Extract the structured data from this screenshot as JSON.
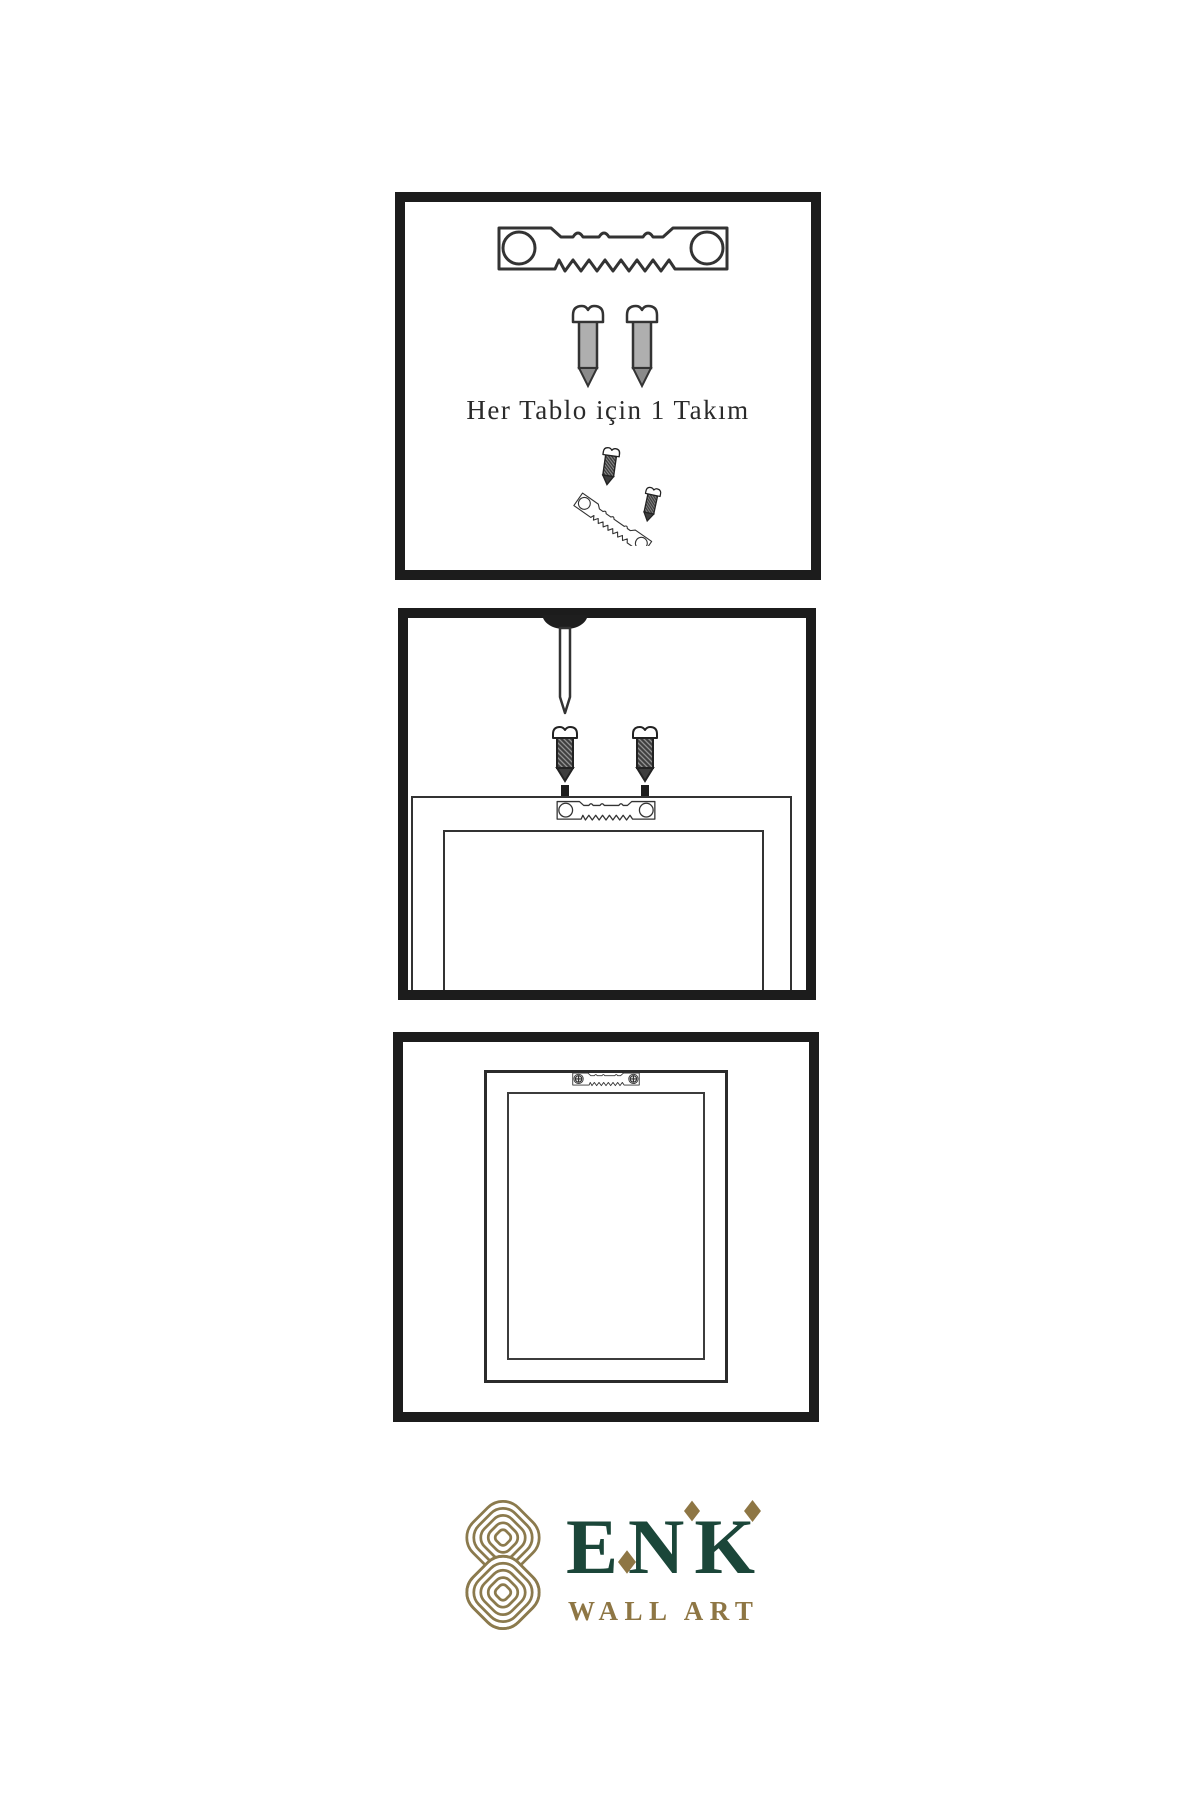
{
  "page": {
    "background": "#ffffff"
  },
  "colors": {
    "panel_border": "#1c1c1c",
    "line_art": "#333333",
    "dark_fill": "#3d3d3d",
    "text": "#2a2a2a"
  },
  "step1": {
    "caption": "Her Tablo için 1 Takım",
    "icons": [
      "sawtooth-hanger-icon",
      "screw-icon",
      "screw-icon",
      "angled-hanger-with-screws-icon"
    ]
  },
  "step2": {
    "icons": [
      "wall-nail-icon",
      "screw-icon",
      "screw-icon",
      "down-arrow-icon",
      "down-arrow-icon",
      "frame-back-with-hanger-icon"
    ]
  },
  "step3": {
    "icons": [
      "hung-frame-with-hanger-icon"
    ]
  },
  "brand": {
    "name": "ENK",
    "subtitle": "WALL ART",
    "logo_icon": "interlaced-knot-icon",
    "colors": {
      "green": "#1b4639",
      "gold": "#8e7644",
      "knot_gold": "#8b7a4d"
    }
  }
}
